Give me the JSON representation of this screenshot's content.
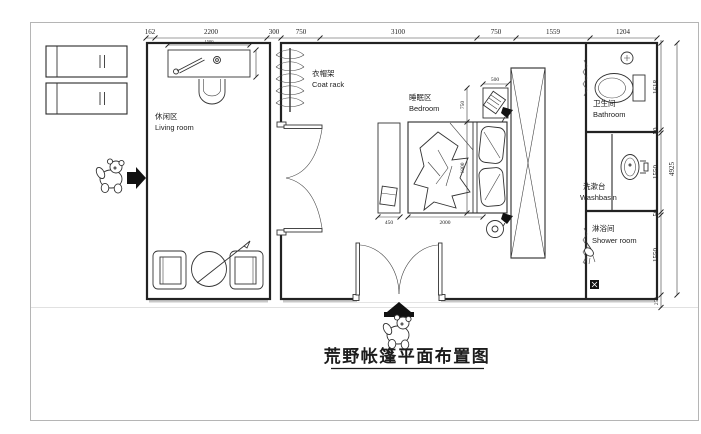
{
  "title": {
    "text": "荒野帐篷平面布置图"
  },
  "rooms": {
    "living": {
      "zh": "休闲区",
      "en": "Living room"
    },
    "coat_rack": {
      "zh": "衣帽架",
      "en": "Coat rack"
    },
    "bedroom": {
      "zh": "睡眠区",
      "en": "Bedroom"
    },
    "bathroom": {
      "zh": "卫生间",
      "en": "Bathroom"
    },
    "washbasin": {
      "zh": "洗漱台",
      "en": "Washbasin"
    },
    "shower": {
      "zh": "淋浴间",
      "en": "Shower room"
    }
  },
  "dims": {
    "top": [
      "162",
      "2200",
      "300",
      "750",
      "3100",
      "750",
      "1559",
      "1204"
    ],
    "right": [
      "1618",
      "50",
      "1550",
      "50",
      "1550",
      "250"
    ],
    "right_overall": "4925",
    "bed_length": "2000",
    "bed_width": "1800",
    "bed_head_row": "750",
    "rack_width": "500",
    "bench_width": "450",
    "desk_width": "1500"
  },
  "icons": [
    "north-arrow",
    "bear-mascot",
    "entrance-arrow",
    "coat-hanger-rack",
    "toilet",
    "ceiling-light",
    "washbasin",
    "shower-head",
    "floor-drain",
    "wall-lamp",
    "ceiling-lamp",
    "wardrobe-cross-box"
  ],
  "colors": {
    "line": "#1f1f1f",
    "canvas_border": "#b5b5b5",
    "wall_shadow": "#c9c9c9"
  }
}
